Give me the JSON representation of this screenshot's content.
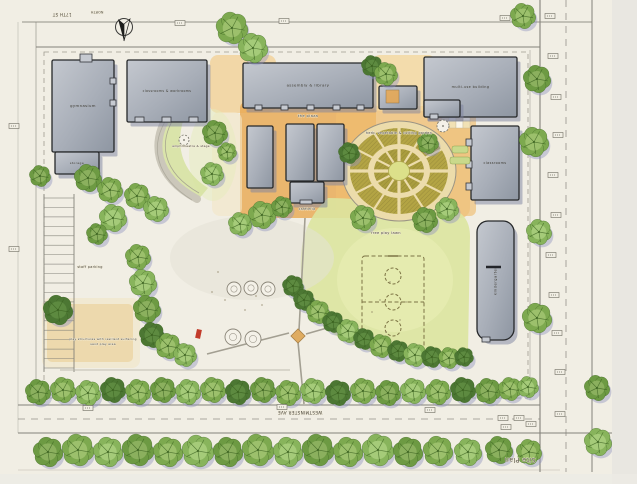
{
  "title": "Site Plan",
  "colors": {
    "paper": "#f1eee4",
    "margin": "#e9e7e1",
    "ink": "#45413a",
    "line": "#84827a",
    "building_light": "#c4c8cf",
    "building_dark": "#8e96a2",
    "building_outline": "#26282a",
    "building_shadow": "#7c82a0",
    "plaza_orange": "#e9a850",
    "plaza_light": "#f4d79d",
    "lawn": "#dbe49e",
    "lawn_light": "#e9efb6",
    "tree_greens": [
      "#7da94f",
      "#6d9a43",
      "#88b45c",
      "#71a24a",
      "#4c7733"
    ],
    "tree_centers": [
      "#9cc06c",
      "#8bb05e",
      "#a5cb79",
      "#93b869",
      "#5d8a40"
    ],
    "tree_vein": "#39601f",
    "tree_shadow": "#8d92bf",
    "garden_bed": "#b3a444",
    "garden_bed_inner": "#aa9d3e",
    "garden_path": "#ecdcab",
    "garden_center": "#dce08a",
    "sand": "#ecd8ab",
    "court_line": "#7c7344",
    "red": "#c23b2a"
  },
  "plan": {
    "buildings": [
      {
        "id": "gymnasium",
        "label": "gymnasium",
        "x": 52,
        "y": 60,
        "w": 62,
        "h": 92
      },
      {
        "id": "classrooms-west",
        "label": "classrooms & workrooms",
        "x": 127,
        "y": 60,
        "w": 80,
        "h": 62,
        "ls": 3.2
      },
      {
        "id": "assembly-library",
        "label": "assembly & library",
        "x": 243,
        "y": 63,
        "w": 130,
        "h": 45
      },
      {
        "id": "storage-shed",
        "label": "storage",
        "x": 55,
        "y": 152,
        "w": 44,
        "h": 22,
        "ls": 3
      },
      {
        "id": "classroom-a",
        "label": "",
        "x": 247,
        "y": 126,
        "w": 26,
        "h": 62
      },
      {
        "id": "classroom-b",
        "label": "",
        "x": 286,
        "y": 124,
        "w": 28,
        "h": 57
      },
      {
        "id": "classroom-c",
        "label": "",
        "x": 317,
        "y": 124,
        "w": 27,
        "h": 57
      },
      {
        "id": "cafeteria-building",
        "label": "",
        "x": 290,
        "y": 182,
        "w": 34,
        "h": 21
      },
      {
        "id": "connector",
        "label": "",
        "x": 379,
        "y": 86,
        "w": 38,
        "h": 23
      },
      {
        "id": "multi-use",
        "label": "multi-use building",
        "x": 424,
        "y": 57,
        "w": 93,
        "h": 60,
        "ls": 3.4
      },
      {
        "id": "multi-use-wing",
        "label": "",
        "x": 424,
        "y": 100,
        "w": 36,
        "h": 17
      },
      {
        "id": "classrooms-east",
        "label": "classrooms",
        "x": 471,
        "y": 126,
        "w": 48,
        "h": 74,
        "ls": 3.4
      },
      {
        "id": "kindergarten",
        "label": "kindergarten",
        "x": 477,
        "y": 221,
        "w": 37,
        "h": 119,
        "rx": 11,
        "lr": -90
      }
    ],
    "bumps": [
      [
        80,
        54,
        12,
        8
      ],
      [
        110,
        78,
        6,
        6
      ],
      [
        110,
        100,
        6,
        6
      ],
      [
        135,
        117,
        9,
        5
      ],
      [
        162,
        117,
        9,
        5
      ],
      [
        189,
        117,
        9,
        5
      ],
      [
        255,
        105,
        7,
        5
      ],
      [
        281,
        105,
        7,
        5
      ],
      [
        307,
        105,
        7,
        5
      ],
      [
        333,
        105,
        7,
        5
      ],
      [
        357,
        105,
        7,
        5
      ],
      [
        430,
        114,
        8,
        5
      ],
      [
        466,
        139,
        6,
        7
      ],
      [
        466,
        161,
        6,
        7
      ],
      [
        466,
        183,
        6,
        7
      ],
      [
        300,
        200,
        12,
        4
      ],
      [
        482,
        337,
        8,
        5
      ]
    ],
    "garden": {
      "cx": 399,
      "cy": 171,
      "rx": 57,
      "ry": 50
    },
    "checker": {
      "x": 442,
      "y": 100,
      "cell": 7,
      "cols": 4,
      "rows": 4
    },
    "parking": {
      "x": 44,
      "w": 30,
      "y0": 198,
      "y1": 368,
      "rows": 19
    },
    "play": {
      "circles": [
        [
          234,
          289,
          7
        ],
        [
          251,
          288,
          7
        ],
        [
          268,
          289,
          7
        ],
        [
          233,
          337,
          8
        ],
        [
          253,
          339,
          8
        ]
      ],
      "red": [
        197,
        329,
        5,
        9
      ],
      "dots": [
        [
          225,
          300
        ],
        [
          245,
          310
        ],
        [
          212,
          292
        ],
        [
          380,
          300
        ],
        [
          400,
          320
        ],
        [
          390,
          282
        ],
        [
          372,
          312
        ],
        [
          256,
          296
        ],
        [
          406,
          302
        ],
        [
          386,
          332
        ],
        [
          218,
          272
        ],
        [
          262,
          305
        ]
      ]
    },
    "trees": [
      [
        48,
        452,
        14,
        1
      ],
      [
        78,
        450,
        15,
        0
      ],
      [
        108,
        452,
        14,
        2
      ],
      [
        138,
        450,
        15,
        1
      ],
      [
        168,
        452,
        14,
        0
      ],
      [
        198,
        451,
        15,
        2
      ],
      [
        228,
        452,
        14,
        1
      ],
      [
        258,
        450,
        15,
        0
      ],
      [
        288,
        452,
        14,
        2
      ],
      [
        318,
        450,
        15,
        1
      ],
      [
        348,
        452,
        14,
        0
      ],
      [
        378,
        450,
        15,
        2
      ],
      [
        408,
        452,
        14,
        1
      ],
      [
        438,
        451,
        14,
        0
      ],
      [
        468,
        452,
        13,
        2
      ],
      [
        499,
        450,
        13,
        1
      ],
      [
        529,
        452,
        12,
        0
      ],
      [
        598,
        442,
        13,
        2
      ],
      [
        38,
        392,
        12,
        1
      ],
      [
        63,
        390,
        12,
        0
      ],
      [
        88,
        393,
        12,
        2
      ],
      [
        113,
        390,
        12,
        4
      ],
      [
        138,
        392,
        12,
        0
      ],
      [
        163,
        390,
        12,
        1
      ],
      [
        188,
        392,
        12,
        2
      ],
      [
        213,
        390,
        12,
        0
      ],
      [
        238,
        392,
        12,
        4
      ],
      [
        263,
        390,
        12,
        1
      ],
      [
        288,
        393,
        12,
        0
      ],
      [
        313,
        391,
        12,
        2
      ],
      [
        338,
        393,
        12,
        4
      ],
      [
        363,
        391,
        12,
        0
      ],
      [
        388,
        393,
        12,
        1
      ],
      [
        413,
        391,
        12,
        2
      ],
      [
        438,
        392,
        12,
        0
      ],
      [
        463,
        390,
        12,
        4
      ],
      [
        488,
        391,
        12,
        1
      ],
      [
        510,
        389,
        11,
        0
      ],
      [
        528,
        387,
        10,
        2
      ],
      [
        293,
        286,
        10,
        4
      ],
      [
        304,
        300,
        10,
        4
      ],
      [
        318,
        312,
        11,
        0
      ],
      [
        333,
        322,
        10,
        4
      ],
      [
        348,
        331,
        11,
        2
      ],
      [
        364,
        339,
        10,
        4
      ],
      [
        381,
        346,
        11,
        0
      ],
      [
        398,
        351,
        10,
        4
      ],
      [
        415,
        355,
        11,
        2
      ],
      [
        432,
        357,
        10,
        4
      ],
      [
        449,
        358,
        10,
        0
      ],
      [
        464,
        357,
        9,
        4
      ],
      [
        138,
        257,
        12,
        0
      ],
      [
        143,
        283,
        13,
        2
      ],
      [
        147,
        309,
        13,
        1
      ],
      [
        152,
        335,
        12,
        4
      ],
      [
        168,
        346,
        12,
        0
      ],
      [
        185,
        355,
        11,
        2
      ],
      [
        58,
        310,
        14,
        4
      ],
      [
        88,
        178,
        13,
        1
      ],
      [
        110,
        190,
        12,
        0
      ],
      [
        113,
        218,
        13,
        2
      ],
      [
        97,
        234,
        10,
        1
      ],
      [
        40,
        176,
        10,
        1
      ],
      [
        137,
        196,
        12,
        0
      ],
      [
        156,
        209,
        12,
        2
      ],
      [
        215,
        133,
        12,
        1
      ],
      [
        227,
        152,
        9,
        0
      ],
      [
        212,
        174,
        11,
        2
      ],
      [
        232,
        28,
        15,
        0
      ],
      [
        253,
        48,
        14,
        2
      ],
      [
        372,
        66,
        10,
        4
      ],
      [
        386,
        74,
        11,
        0
      ],
      [
        428,
        143,
        10,
        1
      ],
      [
        363,
        218,
        12,
        0
      ],
      [
        425,
        220,
        12,
        1
      ],
      [
        447,
        209,
        11,
        2
      ],
      [
        349,
        153,
        10,
        4
      ],
      [
        262,
        215,
        13,
        0
      ],
      [
        240,
        224,
        11,
        2
      ],
      [
        282,
        207,
        10,
        1
      ],
      [
        523,
        16,
        12,
        0
      ],
      [
        537,
        79,
        13,
        1
      ],
      [
        534,
        142,
        14,
        0
      ],
      [
        539,
        232,
        12,
        2
      ],
      [
        537,
        318,
        14,
        0
      ],
      [
        597,
        388,
        12,
        1
      ]
    ],
    "tags": [
      [
        180,
        23
      ],
      [
        284,
        21
      ],
      [
        505,
        18
      ],
      [
        550,
        16
      ],
      [
        553,
        56
      ],
      [
        556,
        97
      ],
      [
        558,
        135
      ],
      [
        553,
        175
      ],
      [
        556,
        215
      ],
      [
        551,
        255
      ],
      [
        554,
        295
      ],
      [
        557,
        333
      ],
      [
        560,
        372
      ],
      [
        88,
        408
      ],
      [
        282,
        407
      ],
      [
        430,
        410
      ],
      [
        503,
        418
      ],
      [
        519,
        418
      ],
      [
        531,
        424
      ],
      [
        506,
        427
      ],
      [
        560,
        414
      ],
      [
        14,
        126
      ],
      [
        14,
        249
      ]
    ],
    "labels": [
      {
        "t": "the plaza",
        "x": 308,
        "y": 117,
        "s": 3.8
      },
      {
        "t": "herb, vegetable & cutting garden",
        "x": 399,
        "y": 134,
        "s": 3.4
      },
      {
        "t": "free play lawn",
        "x": 386,
        "y": 234,
        "s": 3.6
      },
      {
        "t": "staff parking",
        "x": 90,
        "y": 268,
        "s": 3.4
      },
      {
        "t": "play structures with resilient surfacing",
        "x": 103,
        "y": 340,
        "s": 2.9
      },
      {
        "t": "sand play area",
        "x": 103,
        "y": 345,
        "s": 2.9
      },
      {
        "t": "amphitheatre & stage",
        "x": 191,
        "y": 147,
        "s": 2.9
      },
      {
        "t": "cafeteria",
        "x": 307,
        "y": 210,
        "s": 3.2
      },
      {
        "t": "17TH ST",
        "x": 62,
        "y": 13,
        "s": 4,
        "r": 180
      },
      {
        "t": "NORTH",
        "x": 97,
        "y": 11,
        "s": 3.2,
        "r": 180
      },
      {
        "t": "WESTMINSTER AVE",
        "x": 300,
        "y": 411,
        "s": 4.2,
        "r": 180
      },
      {
        "t": "Site Plan",
        "x": 520,
        "y": 458,
        "s": 6.5,
        "r": 180,
        "c": "#55514a"
      }
    ]
  }
}
